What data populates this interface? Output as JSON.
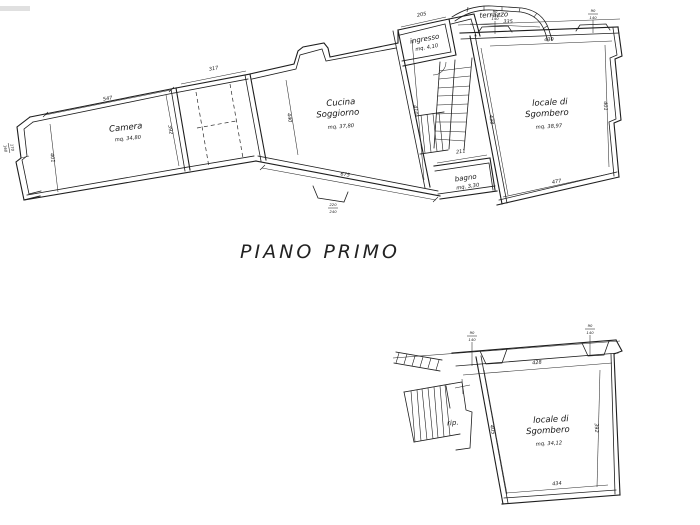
{
  "title": {
    "text": "PIANO PRIMO"
  },
  "colors": {
    "background": "#ffffff",
    "ink": "#1e1e1e"
  },
  "upper_plan": {
    "rooms": {
      "camera": {
        "name": "Camera",
        "area": "mq. 34,80"
      },
      "cucina": {
        "l1": "Cucina",
        "l2": "Soggiorno",
        "area": "mq. 37,80"
      },
      "ingresso": {
        "name": "ingresso",
        "area": "mq. 4,10"
      },
      "terrazzo": {
        "name": "terrazzo"
      },
      "bagno": {
        "name": "bagno",
        "area": "mq. 3,30"
      },
      "sgombero": {
        "l1": "locale di",
        "l2": "Sgombero",
        "area": "mq. 38,97"
      }
    },
    "dims": {
      "camera_top": "547",
      "camera_left": "401",
      "camera_right": "392",
      "corridor_top": "317",
      "cucina_left": "440",
      "cucina_right": "410",
      "cucina_bottom": "675",
      "ingresso_top": "205",
      "terrazzo": "335",
      "bagno_top": "211",
      "sgombero_top": "430",
      "sgombero_left": "438",
      "sgombero_right": "401",
      "sgombero_bottom": "477"
    },
    "window_marks": [
      {
        "top": "90",
        "bottom": "140"
      },
      {
        "top": "90",
        "bottom": "140"
      },
      {
        "top": "170",
        "bottom": "160"
      },
      {
        "top": "220",
        "bottom": "240"
      }
    ]
  },
  "lower_plan": {
    "rooms": {
      "rip": {
        "name": "rip."
      },
      "sgombero": {
        "l1": "locale di",
        "l2": "Sgombero",
        "area": "mq. 34,12"
      }
    },
    "dims": {
      "top": "428",
      "bottom": "434",
      "left": "405",
      "right": "392"
    },
    "window_marks": [
      {
        "top": "90",
        "bottom": "140"
      },
      {
        "top": "90",
        "bottom": "140"
      }
    ]
  }
}
